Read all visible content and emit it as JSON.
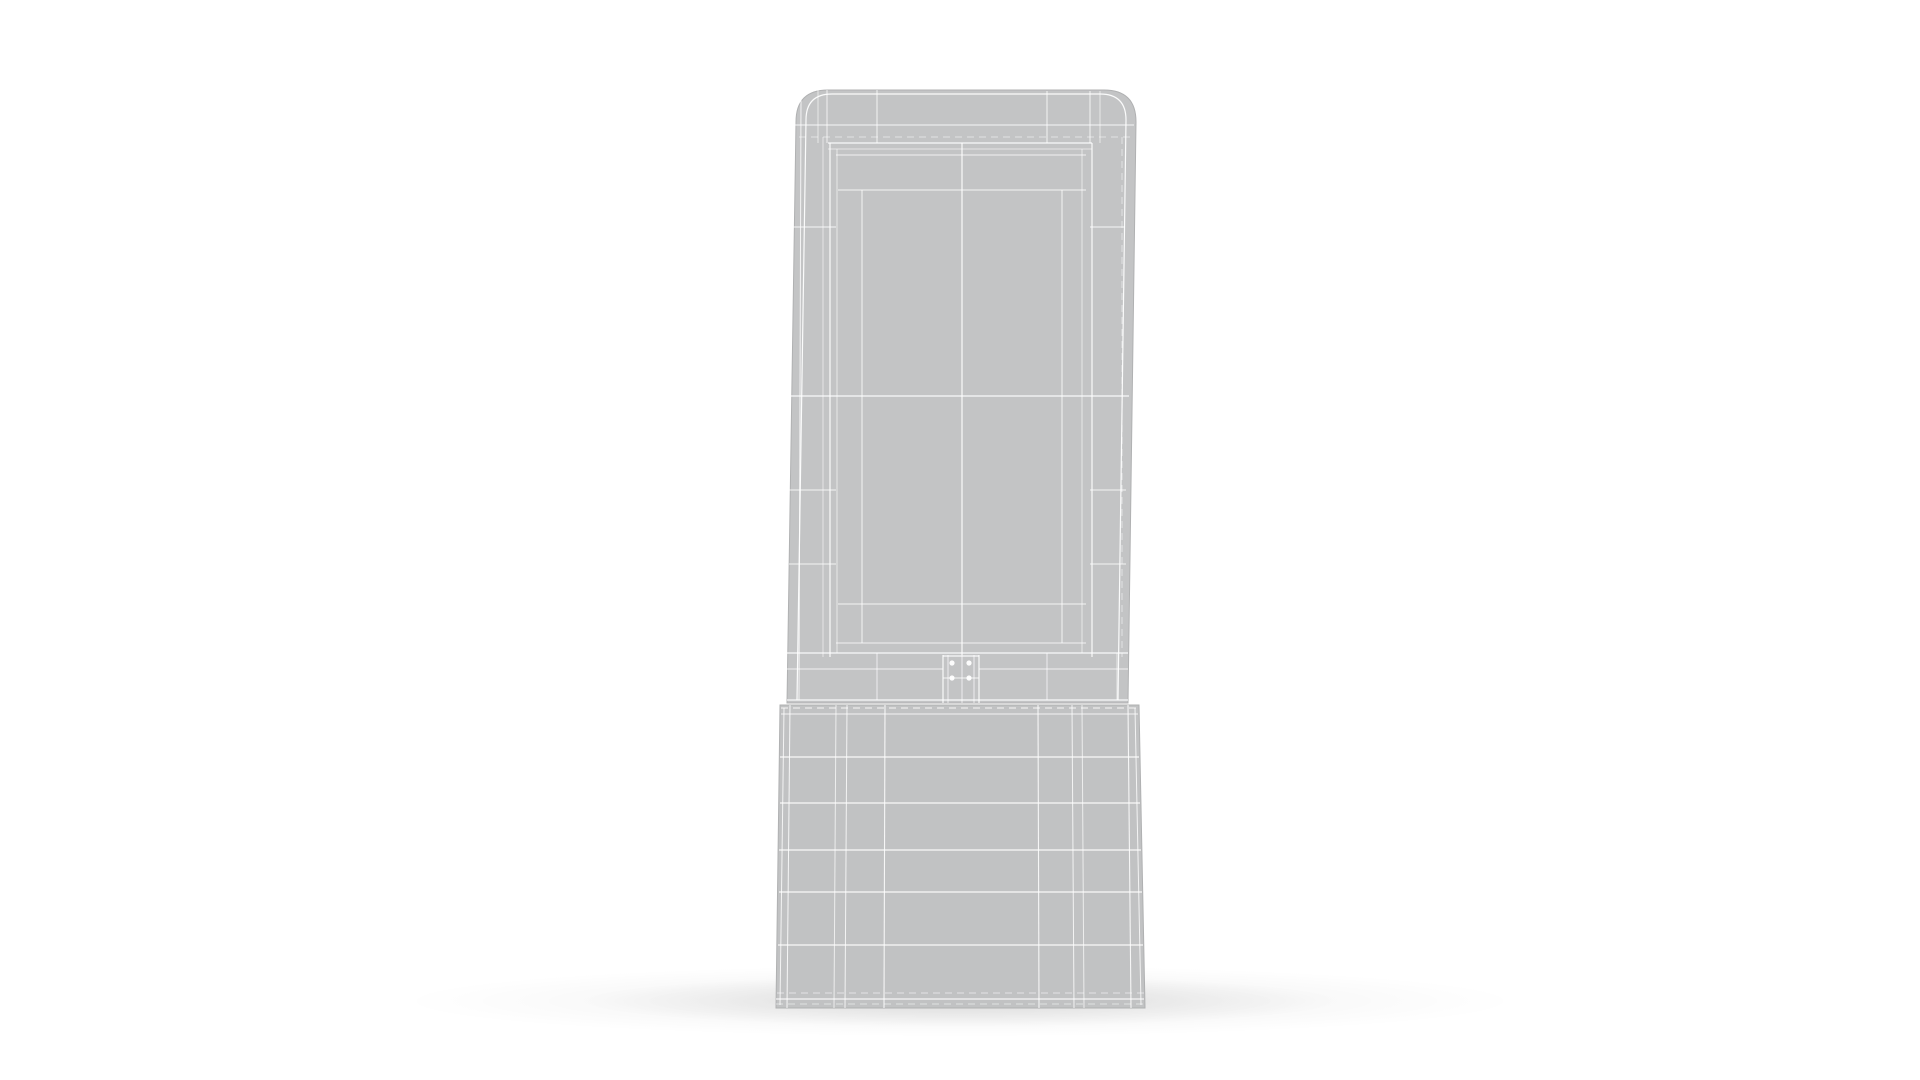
{
  "scene": {
    "description": "3D wireframe clay render of a freestanding digital signage kiosk totem, front view, centered on a plain white background",
    "background_color": "#ffffff",
    "object_fill_color": "#c3c4c5",
    "base_fill_color": "#c1c2c3",
    "wireframe_color": "#ffffff",
    "silhouette_color": "#b0b1b2",
    "shadow_color": "#000000"
  },
  "canvas": {
    "width": 1920,
    "height": 1080
  },
  "kiosk": {
    "panel": {
      "outline": {
        "top_left_x": 796,
        "top_right_x": 1136,
        "bottom_left_x": 787,
        "bottom_right_x": 1128,
        "top_y": 90,
        "bottom_y": 703,
        "corner_radius": 32
      },
      "inset": {
        "side": 10,
        "top": 4,
        "corner_radius": 26
      },
      "lines": [
        [
          787,
          125,
          1134,
          125,
          1.1,
          0.85,
          0
        ],
        [
          787,
          137,
          1133,
          137,
          1,
          0.5,
          1
        ],
        [
          828,
          143,
          1092,
          143,
          1.2,
          0.9,
          0
        ],
        [
          828,
          149,
          1092,
          149,
          1,
          0.55,
          0
        ],
        [
          836,
          155,
          1086,
          155,
          1,
          0.75,
          0
        ],
        [
          838,
          190,
          1086,
          190,
          1,
          0.8,
          0
        ],
        [
          789,
          227,
          836,
          227,
          1,
          0.85,
          0
        ],
        [
          1090,
          227,
          1125,
          227,
          1,
          0.85,
          0
        ],
        [
          788,
          396,
          1129,
          396,
          1.2,
          0.9,
          0
        ],
        [
          789,
          490,
          836,
          490,
          1,
          0.8,
          0
        ],
        [
          1090,
          490,
          1126,
          490,
          1,
          0.8,
          0
        ],
        [
          789,
          564,
          836,
          564,
          1,
          0.8,
          0
        ],
        [
          1090,
          564,
          1126,
          564,
          1,
          0.8,
          0
        ],
        [
          838,
          604,
          1086,
          604,
          1,
          0.8,
          0
        ],
        [
          836,
          643,
          1086,
          643,
          1,
          0.75,
          0
        ],
        [
          787,
          653,
          1128,
          653,
          1.2,
          0.9,
          0
        ],
        [
          787,
          669,
          943,
          669,
          1,
          0.75,
          0
        ],
        [
          979,
          669,
          1128,
          669,
          1,
          0.75,
          0
        ],
        [
          787,
          700,
          1128,
          700,
          1.2,
          0.9,
          0
        ],
        [
          801,
          95,
          799,
          700,
          1,
          0.8,
          0
        ],
        [
          818,
          90,
          818,
          143,
          1,
          0.6,
          0
        ],
        [
          827,
          90,
          827,
          143,
          1,
          0.75,
          0
        ],
        [
          877,
          90,
          877,
          143,
          1,
          0.8,
          0
        ],
        [
          1047,
          91,
          1047,
          143,
          1,
          0.8,
          0
        ],
        [
          1090,
          91,
          1090,
          143,
          1,
          0.8,
          0
        ],
        [
          1100,
          91,
          1100,
          143,
          1,
          0.6,
          0
        ],
        [
          823,
          137,
          823,
          657,
          1,
          0.55,
          0
        ],
        [
          830,
          143,
          830,
          657,
          1.2,
          0.9,
          0
        ],
        [
          837,
          149,
          837,
          653,
          1,
          0.6,
          0
        ],
        [
          862,
          190,
          862,
          643,
          1,
          0.8,
          0
        ],
        [
          962,
          143,
          962,
          655,
          1.2,
          0.9,
          0
        ],
        [
          1062,
          190,
          1062,
          643,
          1,
          0.8,
          0
        ],
        [
          1082,
          149,
          1082,
          653,
          1,
          0.6,
          0
        ],
        [
          1092,
          143,
          1092,
          657,
          1.2,
          0.9,
          0
        ],
        [
          1122,
          137,
          1122,
          657,
          1,
          0.5,
          1
        ],
        [
          877,
          653,
          877,
          700,
          1,
          0.7,
          0
        ],
        [
          1047,
          653,
          1047,
          700,
          1,
          0.7,
          0
        ],
        [
          1117,
          653,
          1117,
          700,
          1,
          0.6,
          0
        ]
      ]
    },
    "bracket": {
      "lines": [
        [
          943,
          655,
          943,
          703,
          1.2,
          0.9,
          0
        ],
        [
          948,
          655,
          948,
          703,
          1,
          0.7,
          0
        ],
        [
          974,
          655,
          974,
          703,
          1,
          0.7,
          0
        ],
        [
          979,
          655,
          979,
          703,
          1.2,
          0.9,
          0
        ],
        [
          943,
          656,
          979,
          656,
          1.2,
          0.9,
          0
        ],
        [
          943,
          678,
          979,
          678,
          1,
          0.8,
          0
        ],
        [
          948,
          700,
          974,
          700,
          1,
          0.7,
          0
        ],
        [
          962,
          655,
          962,
          703,
          1,
          0.7,
          0
        ]
      ],
      "screws": [
        [
          952,
          663
        ],
        [
          969,
          663
        ],
        [
          952,
          678
        ],
        [
          969,
          678
        ]
      ],
      "screw_radius": 2.6
    },
    "base": {
      "outline": {
        "top_left_x": 780,
        "top_right_x": 1139,
        "bottom_left_x": 776,
        "bottom_right_x": 1145,
        "top_y": 705,
        "bottom_y": 1008
      },
      "lines": [
        [
          781,
          708,
          1138,
          708,
          1.1,
          0.85,
          1
        ],
        [
          781,
          714,
          1138,
          714,
          1,
          0.8,
          0
        ],
        [
          780,
          757,
          1139,
          757,
          1.2,
          0.9,
          0
        ],
        [
          780,
          803,
          1140,
          803,
          1.2,
          0.9,
          0
        ],
        [
          779,
          850,
          1141,
          850,
          1.2,
          0.9,
          0
        ],
        [
          779,
          892,
          1142,
          892,
          1.2,
          0.9,
          0
        ],
        [
          778,
          945,
          1143,
          945,
          1.2,
          0.9,
          0
        ],
        [
          777,
          993,
          1144,
          993,
          1,
          0.55,
          1
        ],
        [
          776,
          999,
          1144,
          999,
          1.2,
          0.85,
          0
        ],
        [
          776,
          1004,
          1145,
          1004,
          1,
          0.5,
          1
        ],
        [
          784,
          708,
          780,
          1005,
          1,
          0.8,
          0
        ],
        [
          1135,
          708,
          1141,
          1005,
          1,
          0.8,
          0
        ],
        [
          790,
          705,
          787,
          1008,
          1,
          0.85,
          0
        ],
        [
          836,
          705,
          834,
          1008,
          1,
          0.7,
          0
        ],
        [
          847,
          705,
          845,
          1008,
          1,
          0.8,
          0
        ],
        [
          885,
          705,
          884,
          1008,
          1.1,
          0.85,
          0
        ],
        [
          1038,
          705,
          1039,
          1008,
          1.1,
          0.85,
          0
        ],
        [
          1072,
          705,
          1074,
          1008,
          1,
          0.8,
          0
        ],
        [
          1082,
          705,
          1084,
          1008,
          1,
          0.7,
          0
        ],
        [
          1128,
          705,
          1131,
          1008,
          1.1,
          0.85,
          0
        ]
      ]
    },
    "shadow": {
      "cx": 960,
      "cy": 1001,
      "rx": 380,
      "ry": 26,
      "outer_rx": 560,
      "outer_ry": 36
    }
  }
}
